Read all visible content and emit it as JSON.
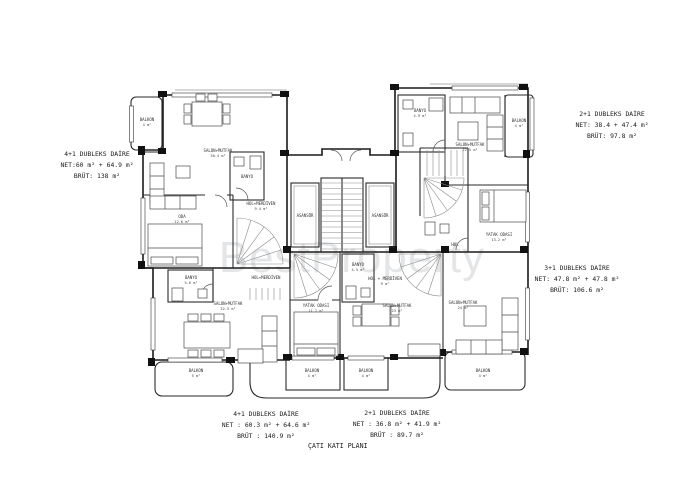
{
  "plan": {
    "title": "ÇATI KATI PLANI",
    "watermark": "BestProperty"
  },
  "annotations": [
    {
      "name": "4+1 DUBLEKS DAİRE",
      "net": "NET:60 m² + 64.9 m²",
      "brut": "BRÜT: 138 m²"
    },
    {
      "name": "2+1 DUBLEKS DAİRE",
      "net": "NET: 38.4 + 47.4 m²",
      "brut": "BRÜT: 97.8 m²"
    },
    {
      "name": "3+1 DUBLEKS DAİRE",
      "net": "NET: 47.8 m² + 47.8 m²",
      "brut": "BRÜT: 106.6 m²"
    },
    {
      "name": "4+1 DUBLEKS DAİRE",
      "net": "NET : 60.3 m² + 64.6 m²",
      "brut": "BRÜT : 140.9 m²"
    },
    {
      "name": "2+1 DUBLEKS DAİRE",
      "net": "NET : 36.8 m² + 41.9 m²",
      "brut": "BRÜT : 89.7 m²"
    }
  ],
  "rooms": {
    "tl_balkon": {
      "label": "BALKON",
      "area": "4 m²"
    },
    "tl_salon": {
      "label": "SALON+MUTFAK",
      "area": "30.4 m²"
    },
    "tl_banyo": {
      "label": "BANYO",
      "area": ""
    },
    "tl_oda": {
      "label": "ODA",
      "area": "12.6 m²"
    },
    "tl_hol": {
      "label": "HOL+MERDİVEN",
      "area": "9.4 m²"
    },
    "tr_banyo": {
      "label": "BANYO",
      "area": "4.9 m²"
    },
    "tr_salon": {
      "label": "SALON+MUTFAK",
      "area": "22.5 m²"
    },
    "tr_balkon": {
      "label": "BALKON",
      "area": "4 m²"
    },
    "asansor_l": {
      "label": "ASANSÖR"
    },
    "asansor_r": {
      "label": "ASANSÖR"
    },
    "r_yatak": {
      "label": "YATAK ODASI",
      "area": "13.2 m²"
    },
    "r_hol": {
      "label": "HOL",
      "area": ""
    },
    "bl_banyo": {
      "label": "BANYO",
      "area": "5.6 m²"
    },
    "bl_hol": {
      "label": "HOL+MERDİVEN",
      "area": ""
    },
    "bl_salon": {
      "label": "SALON+MUTFAK",
      "area": "32.5 m²"
    },
    "bl_balkon": {
      "label": "BALKON",
      "area": "5 m²"
    },
    "bc_yatak": {
      "label": "YATAK ODASI",
      "area": "11.1 m²"
    },
    "bc_salon": {
      "label": "SALON+MUTFAK",
      "area": "23 m²"
    },
    "bc_hol": {
      "label": "HOL + MERDİVEN",
      "area": "9 m²"
    },
    "bc_banyo": {
      "label": "BANYO",
      "area": "4.5 m²"
    },
    "bc_balkon1": {
      "label": "BALKON",
      "area": "4 m²"
    },
    "bc_balkon2": {
      "label": "BALKON",
      "area": "4 m²"
    },
    "br_salon": {
      "label": "SALON+MUTFAK",
      "area": "24 m²"
    },
    "br_balkon": {
      "label": "BALKON",
      "area": "4 m²"
    }
  }
}
